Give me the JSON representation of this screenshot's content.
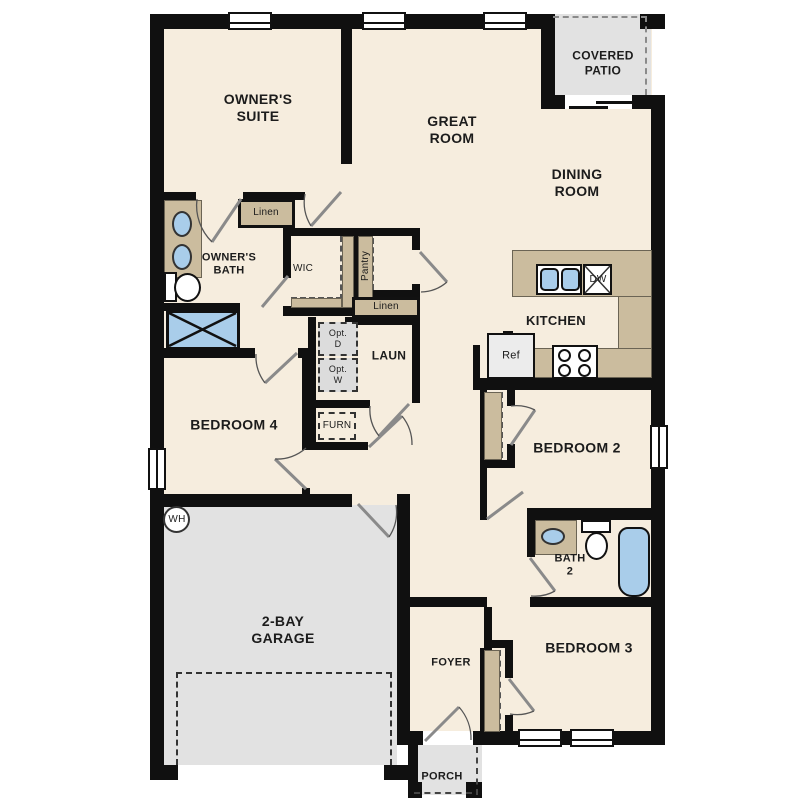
{
  "plan_title": "Single-story floor plan",
  "colors": {
    "floor": "#f6edde",
    "walls": "#101010",
    "garage_patio_gray": "#e2e2e2",
    "cabinet_tan": "#cbbc9e",
    "fixture_blue": "#a9cdea",
    "appliance_gray": "#ececec"
  },
  "rooms": {
    "owners_suite": "OWNER'S\nSUITE",
    "great_room": "GREAT\nROOM",
    "covered_patio": "COVERED\nPATIO",
    "dining_room": "DINING\nROOM",
    "owners_bath": "OWNER'S\nBATH",
    "wic": "WIC",
    "linen_upper": "Linen",
    "pantry": "Pantry",
    "linen_lower": "Linen",
    "kitchen": "KITCHEN",
    "laundry": "LAUN",
    "opt_d": "Opt.\nD",
    "opt_w": "Opt.\nW",
    "furnace": "FURN",
    "bedroom4": "BEDROOM 4",
    "bedroom2": "BEDROOM 2",
    "bath2": "BATH\n2",
    "bedroom3": "BEDROOM 3",
    "garage": "2-BAY\nGARAGE",
    "foyer": "FOYER",
    "porch": "PORCH"
  },
  "fixtures": {
    "water_heater": "WH",
    "refrigerator": "Ref",
    "dishwasher": "DW"
  }
}
